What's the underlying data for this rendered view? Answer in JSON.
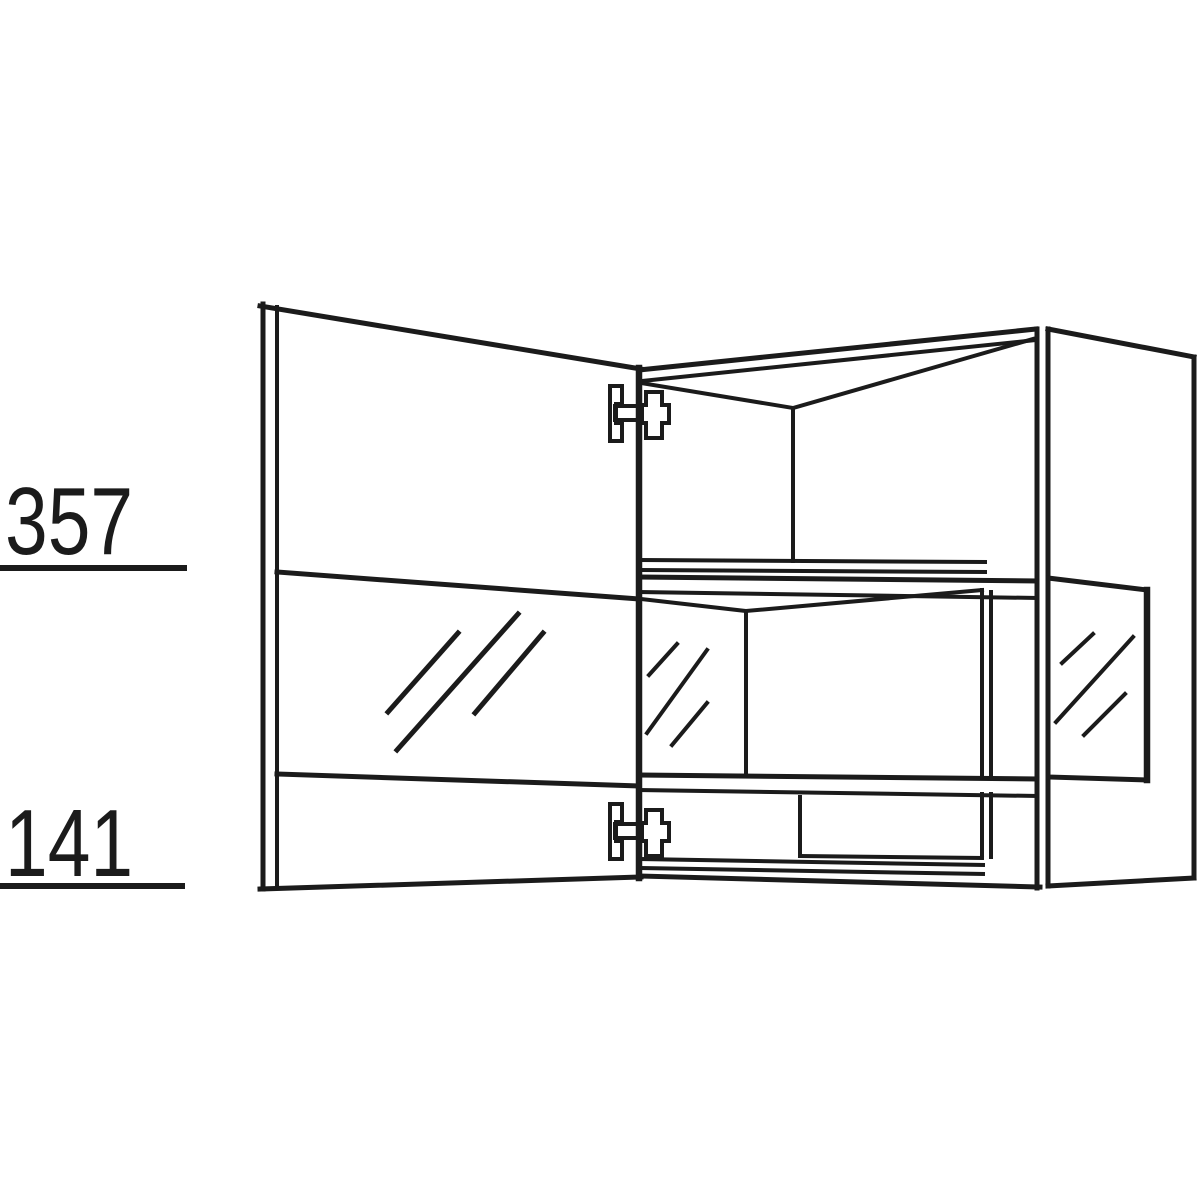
{
  "diagram": {
    "kind": "wall-cabinet-technical-line-drawing",
    "background": "#ffffff",
    "line_color": "#1b1b1b"
  },
  "dimensions": [
    {
      "label": "357"
    },
    {
      "label": "141"
    }
  ]
}
